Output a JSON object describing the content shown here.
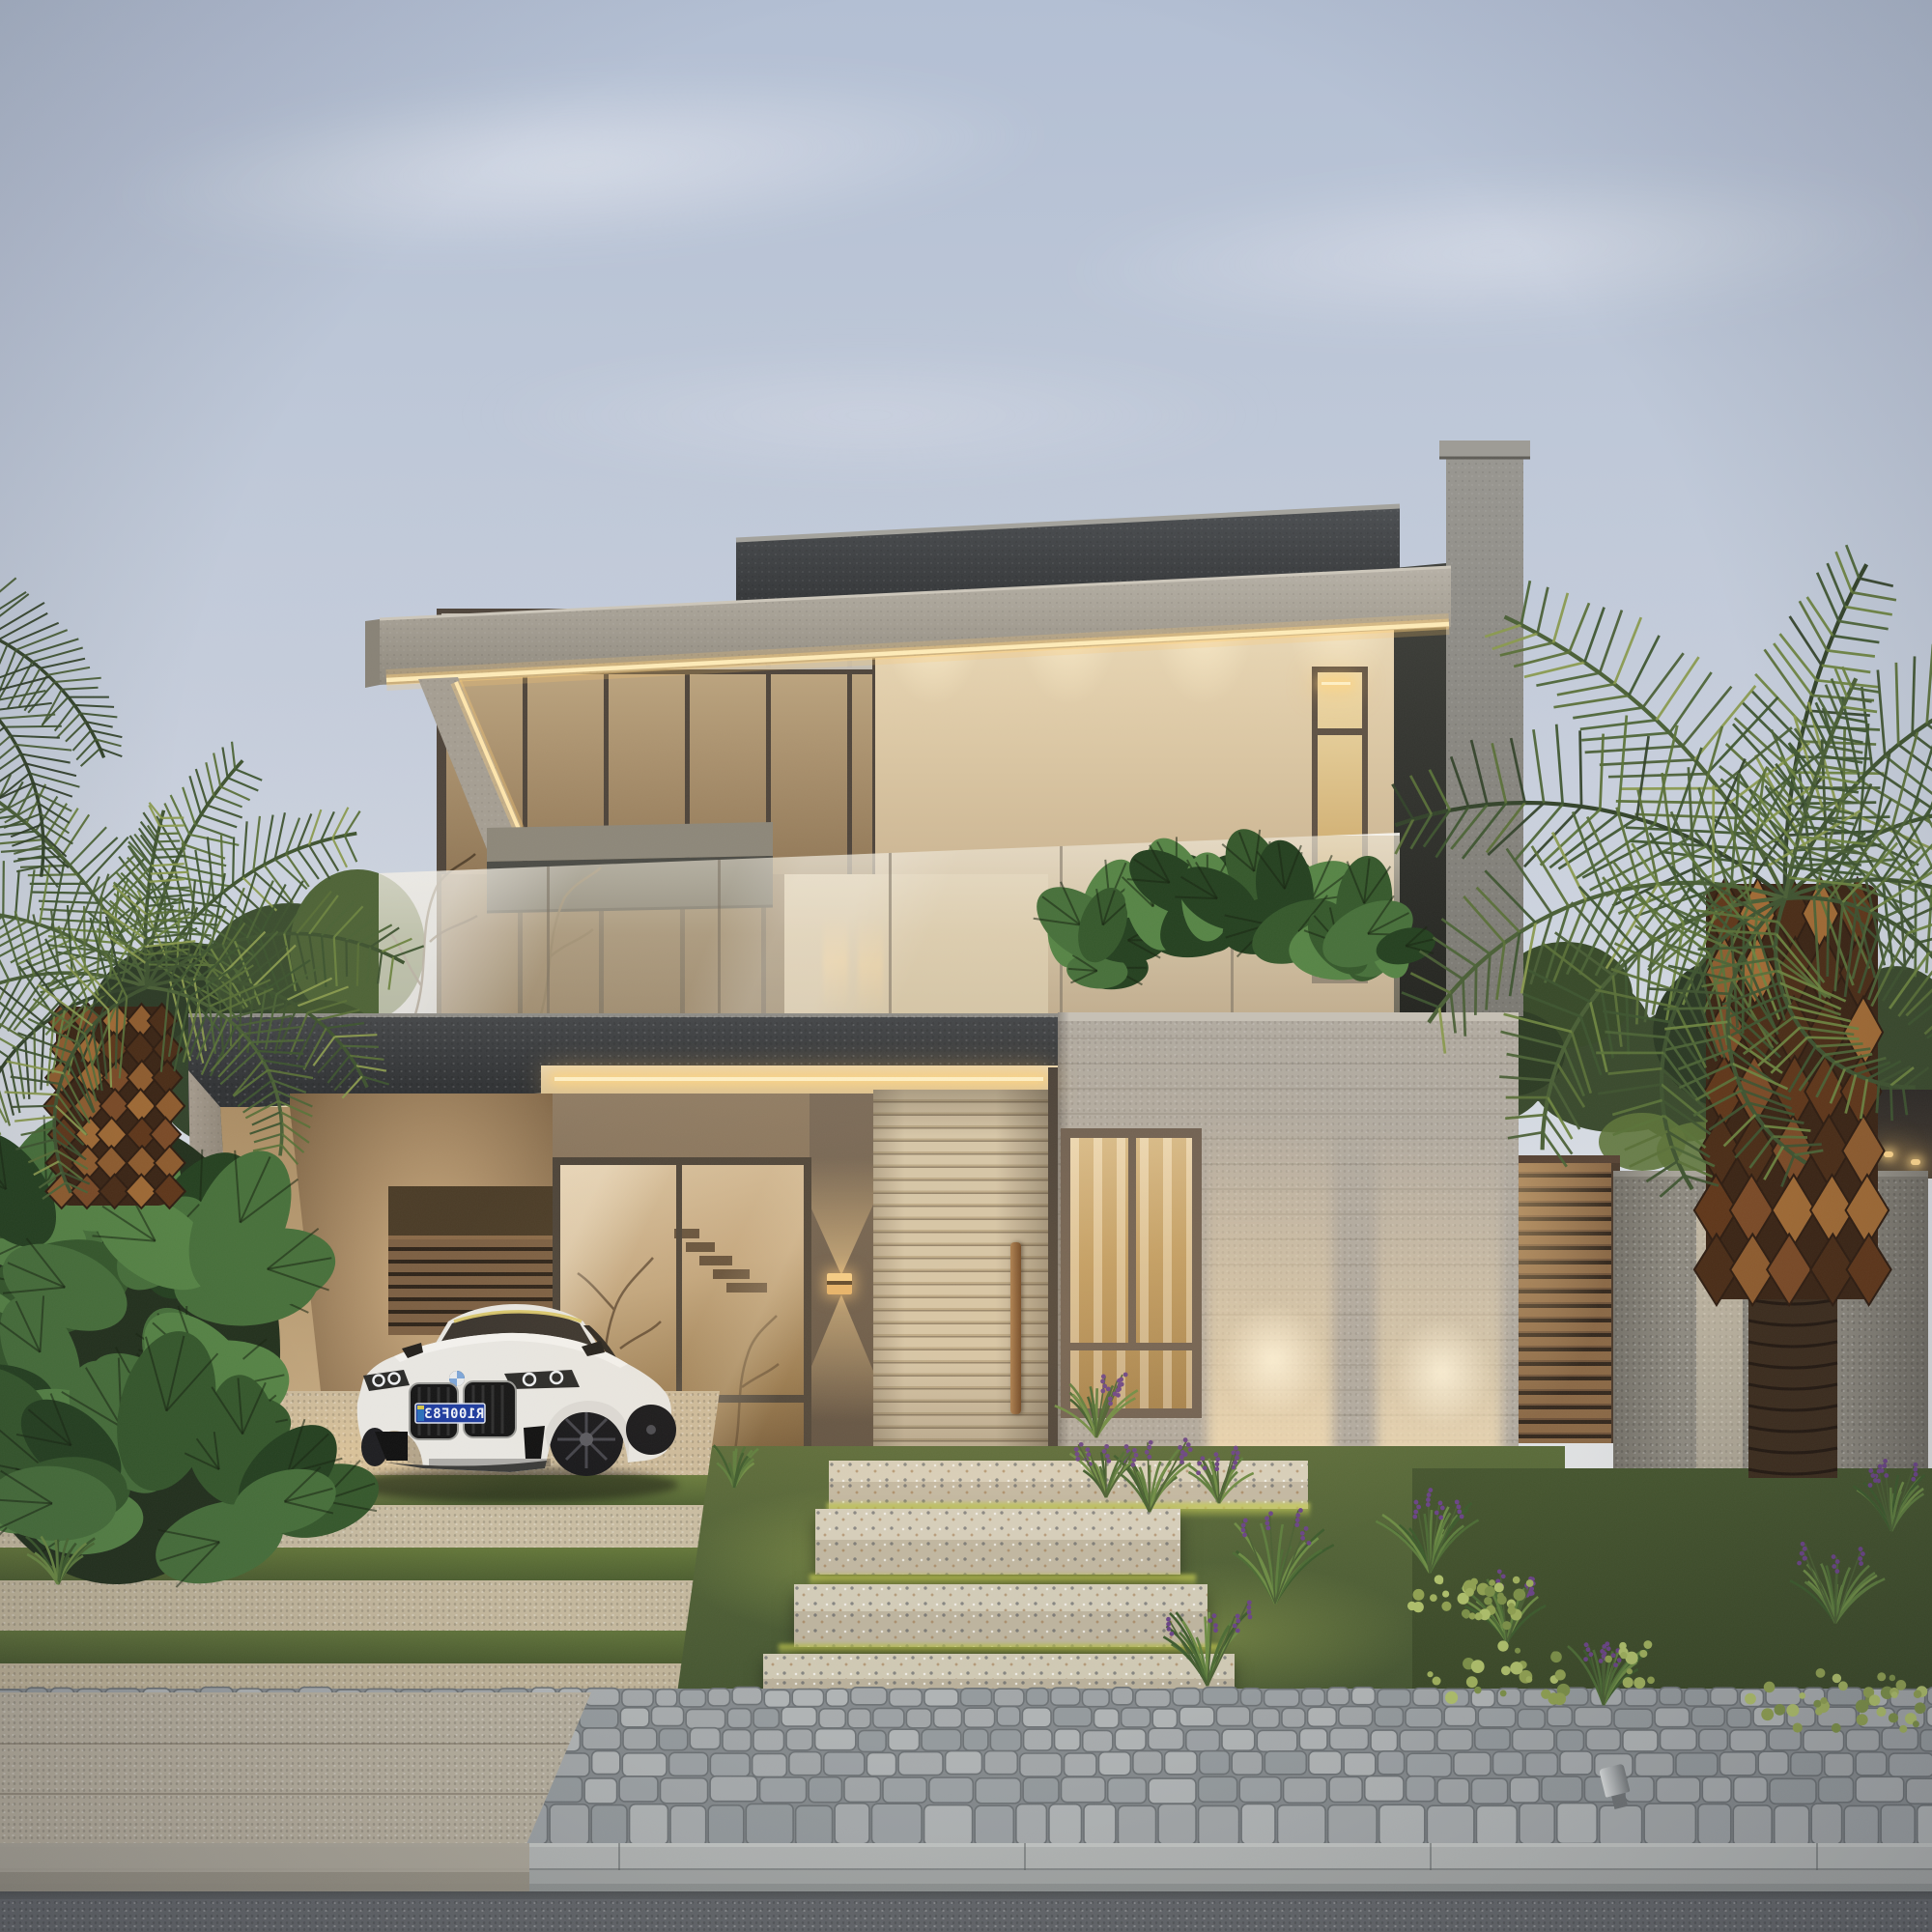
{
  "title": "Contemporary two-storey house at dusk — architectural rendering",
  "colors": {
    "sky_top": "#b3bfd4",
    "sky_low": "#e4e4e2",
    "charcoal": "#3c3e40",
    "charcoal_deep": "#2c2e30",
    "concrete": "#a39c91",
    "concrete_light": "#b8b2a7",
    "concrete_dark": "#8b857a",
    "beige_wall": "#e6d5b4",
    "beige_deep": "#c2ab87",
    "glass_bronze": "#c5a87f",
    "glass_bronze_dark": "#7b653f",
    "frame_dark": "#554a3d",
    "led_warm": "#ffe9b0",
    "led_core": "#fff3cf",
    "door_beige": "#cfc0a3",
    "door_gap": "#8e8069",
    "handle_wood": "#8a5f37",
    "brown_wall": "#6f6052",
    "board_concrete": "#b2aba0",
    "rail_glass": "#e4dcc6",
    "plate_blue": "#1e3c9e",
    "plate_text": "#f0f3f9",
    "car_body": "#e9e7e2",
    "car_glass": "#3a342d",
    "grille_black": "#141414",
    "wheel_dark": "#1b1b1d",
    "grass": "#4f6233",
    "grass_lit": "#a9b244",
    "lawn_dark": "#42522c",
    "leaf_dark": "#2b3d24",
    "leaf_mid": "#3e5530",
    "leaf_light": "#5a7339",
    "palm_light": "#8a9a4e",
    "trunk_brown": "#7b4a26",
    "trunk_dark": "#332214",
    "fence_wood": "#8a6845",
    "fence_gap": "#33271c",
    "stone_wall": "#8f8b81",
    "step_stone": "#d3cbb6",
    "cobble": "#9ba0a3",
    "cobble_joint": "#6c7174",
    "curb": "#b0b3b2",
    "asphalt": "#606366",
    "flower_purple": "#6a4386",
    "sconce_glow": "#ffd896"
  },
  "scene": {
    "setting": {
      "time_of_day": "dusk",
      "sky": "clear-gradient"
    },
    "house": {
      "storeys": 2,
      "elements": [
        "dark-parapet-roof-volume",
        "concrete-roof-fascia-with-led-strip",
        "cantilevered-pergola-frame",
        "upper-window-wall",
        "beige-stucco-wall",
        "vertical-slot-window",
        "glass-balustrade-balcony",
        "rooftop-planter-monstera",
        "board-formed-concrete-entry-volume",
        "entry-volume-window",
        "slatted-pivot-entry-door",
        "wall-sconce-up-down-light",
        "ground-floor-glass-wall",
        "carport-with-led-ceiling-strips",
        "board-formed-side-wall"
      ]
    },
    "car": {
      "type": "coupe",
      "color_name": "white",
      "badge": "bmw-roundel",
      "license_plate": "R100F83",
      "plate_mirrored": true
    },
    "landscape": [
      "phoenix-palm-left",
      "phoenix-palm-right",
      "monstera-bed-left",
      "lavender-grass-tufts",
      "floating-terrazzo-steps",
      "grass-strip-driveway",
      "cobblestone-sidewalk",
      "granite-curb",
      "asphalt-road",
      "horizontal-slat-fence",
      "granite-stone-wall",
      "garden-spotlight",
      "groundcover-bed"
    ]
  }
}
